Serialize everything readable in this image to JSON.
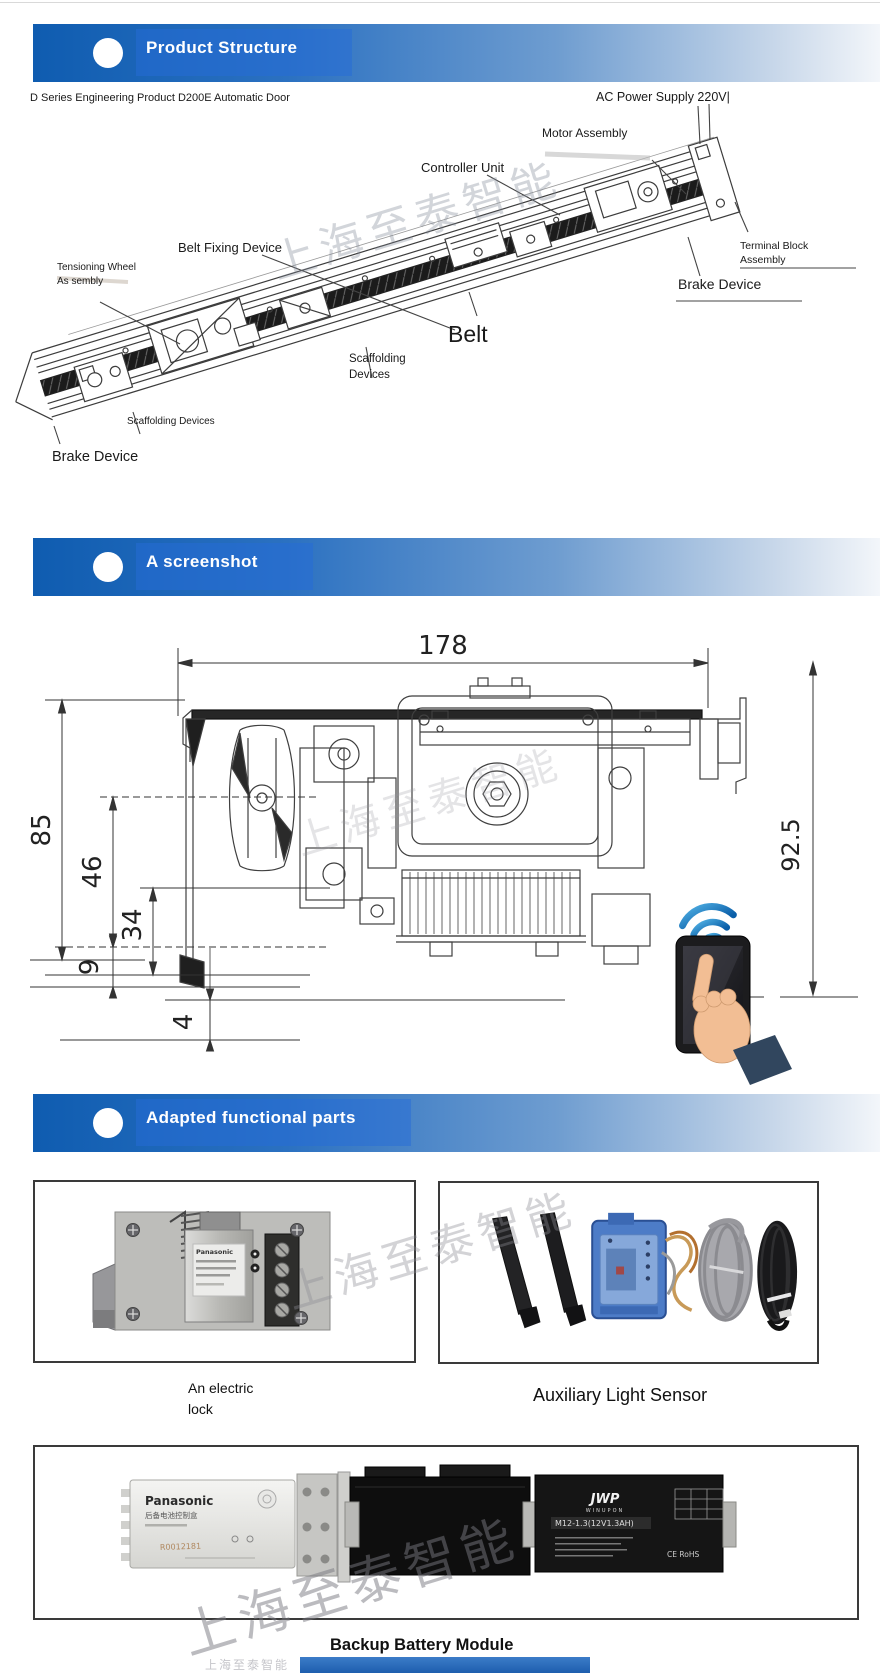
{
  "banners": [
    {
      "title": "Product Structure"
    },
    {
      "title": "A screenshot"
    },
    {
      "title": "Adapted functional parts"
    }
  ],
  "watermark": {
    "text": "上海至泰智能"
  },
  "structure_diagram": {
    "caption": "D Series Engineering Product D200E Automatic Door",
    "labels": {
      "ac_power": "AC Power Supply 220V|",
      "motor": "Motor Assembly",
      "controller": "Controller Unit",
      "belt_fixing": "Belt Fixing Device",
      "terminal_block_line1": "Terminal Block",
      "terminal_block_line2": "Assembly",
      "brake_right": "Brake Device",
      "tensioning_line1": "Tensioning Wheel",
      "tensioning_line2": "As sembly",
      "scaffolding_mid_line1": "Scaffolding",
      "scaffolding_mid_line2": "Devices",
      "belt": "Belt",
      "scaffolding_left": "Scaffolding Devices",
      "brake_left": "Brake Device"
    }
  },
  "dimension_drawing": {
    "width_top": "178",
    "height_total": "85",
    "dim_46": "46",
    "dim_34": "34",
    "dim_9": "9",
    "dim_4": "4",
    "height_right": "92.5"
  },
  "parts": {
    "electric_lock": {
      "caption_line1": "An electric",
      "caption_line2": "lock",
      "brand": "Panasonic"
    },
    "light_sensor": {
      "caption": "Auxiliary Light Sensor"
    },
    "battery": {
      "caption": "Backup Battery Module",
      "brand": "Panasonic",
      "brand_sub": "后备电池控制盒",
      "stamp": "R0012181",
      "logo": "JWP",
      "logo_sub": "WINUPON",
      "model": "M12-1.3(12V1.3AH)",
      "cert": "CE  RoHS"
    }
  },
  "colors": {
    "banner_blue": "#0f5cb0",
    "wifi_blue": "#1c74b8",
    "bottom_bar_blue": "#2e72c2"
  }
}
